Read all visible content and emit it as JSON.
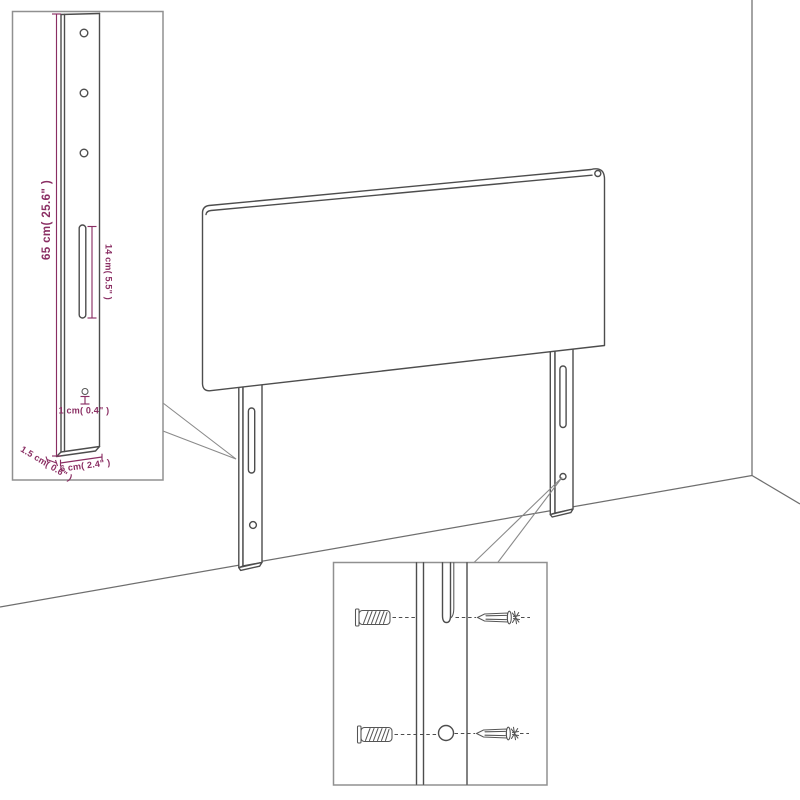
{
  "scene": {
    "background": "#ffffff",
    "subject": "headboard-with-wall-mount-legs",
    "room": "wall-corner-and-floor-lines"
  },
  "colors": {
    "artwork_line": "#4d4d4d",
    "room_line": "#6e6e6e",
    "callout_border": "#909090",
    "dimension": "#8a2e63"
  },
  "leg_detail_callout": {
    "dimensions": {
      "height": "65 cm( 25.6\" )",
      "slot_length": "14 cm( 5.5\" )",
      "hole": "1 cm( 0.4\" )",
      "thickness": "1.5 cm( 0.6\" )",
      "width": "6 cm( 2.4\" )"
    }
  },
  "mount_detail_callout": {
    "hardware": {
      "top_row": [
        "wall-plug-icon",
        "screw-icon"
      ],
      "bottom_row": [
        "wall-plug-icon",
        "screw-icon"
      ]
    }
  }
}
